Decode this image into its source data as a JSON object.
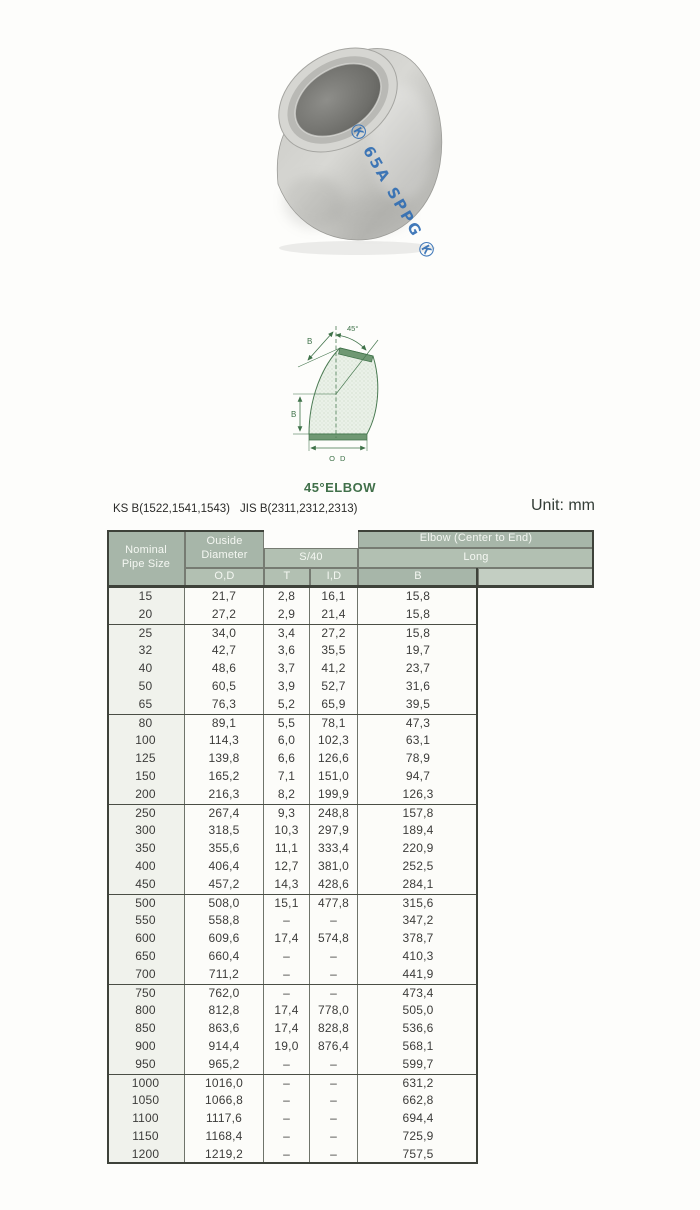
{
  "photo": {
    "stamp_text": "Ⓚ 65A SPPG Ⓚ",
    "stamp_color": "#2e6cb3"
  },
  "diagram": {
    "caption": "45°ELBOW",
    "angle_label": "45°",
    "b_top_label": "B",
    "b_side_label": "B",
    "od_label": "O D",
    "accent": "#3f7249"
  },
  "standards": {
    "ks": "KS B(1522,1541,1543)",
    "jis": "JIS B(2311,2312,2313)",
    "unit": "Unit: mm"
  },
  "table": {
    "header": {
      "nominal": "Nominal Pipe Size",
      "outside_diameter": "Ouside Diameter",
      "od_sub": "O,D",
      "schedule": "S/40",
      "t": "T",
      "id": "I,D",
      "elbow": "Elbow (Center to End)",
      "long": "Long",
      "b": "B"
    },
    "columns": [
      "Nominal Pipe Size",
      "O,D",
      "T",
      "I,D",
      "B"
    ],
    "groups": [
      [
        [
          "15",
          "21,7",
          "2,8",
          "16,1",
          "15,8"
        ],
        [
          "20",
          "27,2",
          "2,9",
          "21,4",
          "15,8"
        ]
      ],
      [
        [
          "25",
          "34,0",
          "3,4",
          "27,2",
          "15,8"
        ],
        [
          "32",
          "42,7",
          "3,6",
          "35,5",
          "19,7"
        ],
        [
          "40",
          "48,6",
          "3,7",
          "41,2",
          "23,7"
        ],
        [
          "50",
          "60,5",
          "3,9",
          "52,7",
          "31,6"
        ],
        [
          "65",
          "76,3",
          "5,2",
          "65,9",
          "39,5"
        ]
      ],
      [
        [
          "80",
          "89,1",
          "5,5",
          "78,1",
          "47,3"
        ],
        [
          "100",
          "114,3",
          "6,0",
          "102,3",
          "63,1"
        ],
        [
          "125",
          "139,8",
          "6,6",
          "126,6",
          "78,9"
        ],
        [
          "150",
          "165,2",
          "7,1",
          "151,0",
          "94,7"
        ],
        [
          "200",
          "216,3",
          "8,2",
          "199,9",
          "126,3"
        ]
      ],
      [
        [
          "250",
          "267,4",
          "9,3",
          "248,8",
          "157,8"
        ],
        [
          "300",
          "318,5",
          "10,3",
          "297,9",
          "189,4"
        ],
        [
          "350",
          "355,6",
          "11,1",
          "333,4",
          "220,9"
        ],
        [
          "400",
          "406,4",
          "12,7",
          "381,0",
          "252,5"
        ],
        [
          "450",
          "457,2",
          "14,3",
          "428,6",
          "284,1"
        ]
      ],
      [
        [
          "500",
          "508,0",
          "15,1",
          "477,8",
          "315,6"
        ],
        [
          "550",
          "558,8",
          "–",
          "–",
          "347,2"
        ],
        [
          "600",
          "609,6",
          "17,4",
          "574,8",
          "378,7"
        ],
        [
          "650",
          "660,4",
          "–",
          "–",
          "410,3"
        ],
        [
          "700",
          "711,2",
          "–",
          "–",
          "441,9"
        ]
      ],
      [
        [
          "750",
          "762,0",
          "–",
          "–",
          "473,4"
        ],
        [
          "800",
          "812,8",
          "17,4",
          "778,0",
          "505,0"
        ],
        [
          "850",
          "863,6",
          "17,4",
          "828,8",
          "536,6"
        ],
        [
          "900",
          "914,4",
          "19,0",
          "876,4",
          "568,1"
        ],
        [
          "950",
          "965,2",
          "–",
          "–",
          "599,7"
        ]
      ],
      [
        [
          "1000",
          "1016,0",
          "–",
          "–",
          "631,2"
        ],
        [
          "1050",
          "1066,8",
          "–",
          "–",
          "662,8"
        ],
        [
          "1100",
          "1117,6",
          "–",
          "–",
          "694,4"
        ],
        [
          "1150",
          "1168,4",
          "–",
          "–",
          "725,9"
        ],
        [
          "1200",
          "1219,2",
          "–",
          "–",
          "757,5"
        ]
      ]
    ]
  },
  "colors": {
    "accent_green": "#41704a",
    "header_bg_dark": "#a7b6a9",
    "header_bg_mid": "#b2c0b2",
    "header_bg_light": "#c3cec2",
    "stamp_blue": "#2e6cb3"
  }
}
